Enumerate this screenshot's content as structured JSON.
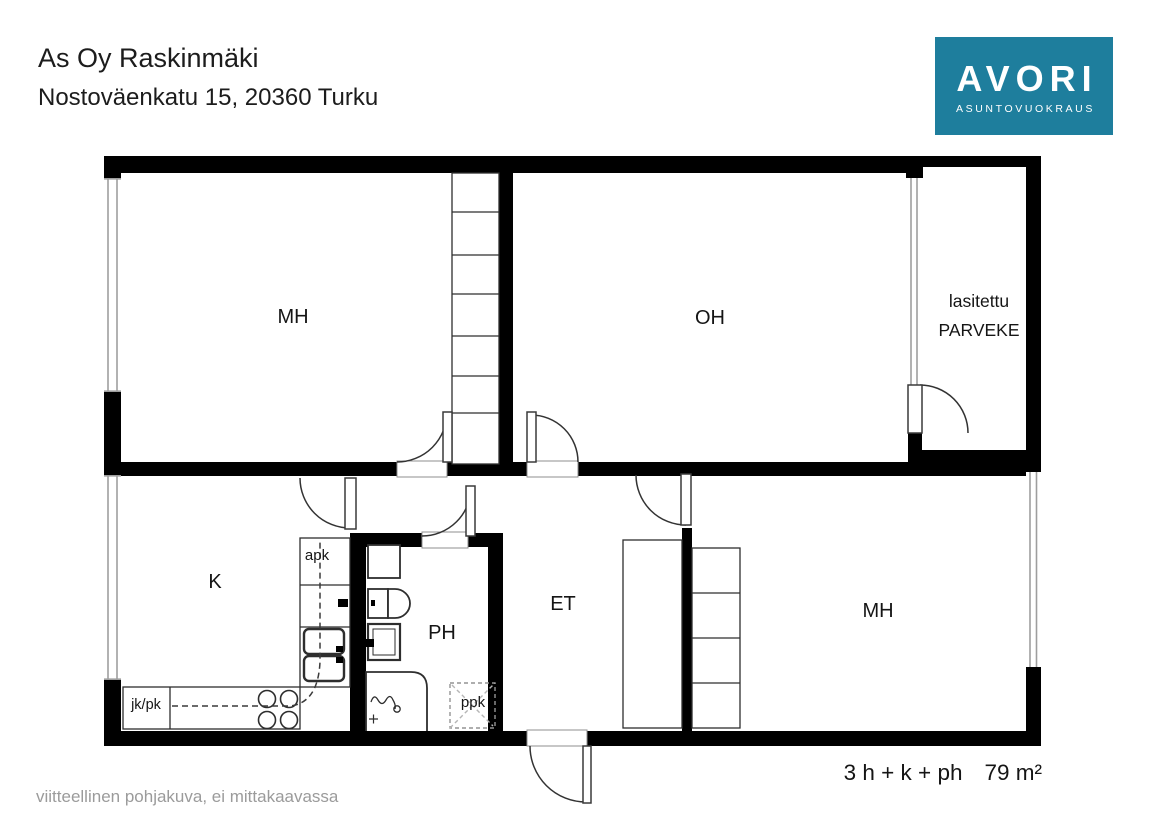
{
  "header": {
    "title": "As Oy Raskinmäki",
    "address": "Nostoväenkatu 15, 20360 Turku"
  },
  "logo": {
    "brand": "AVORI",
    "tagline": "ASUNTOVUOKRAUS",
    "accent_teal": "#1e7e9d",
    "bg_style": "background:#1e7e9d"
  },
  "floorplan": {
    "rooms": {
      "bedroom1": "MH",
      "living": "OH",
      "balcony_line1": "lasitettu",
      "balcony_line2": "PARVEKE",
      "kitchen": "K",
      "bathroom": "PH",
      "hall": "ET",
      "bedroom2": "MH"
    },
    "fixtures": {
      "dishwasher": "apk",
      "fridge_freezer": "jk/pk",
      "washing_machine": "ppk"
    }
  },
  "footer": {
    "disclaimer": "viitteellinen pohjakuva, ei mittakaavassa",
    "layout": "3 h + k + ph",
    "area": "79 m²"
  }
}
